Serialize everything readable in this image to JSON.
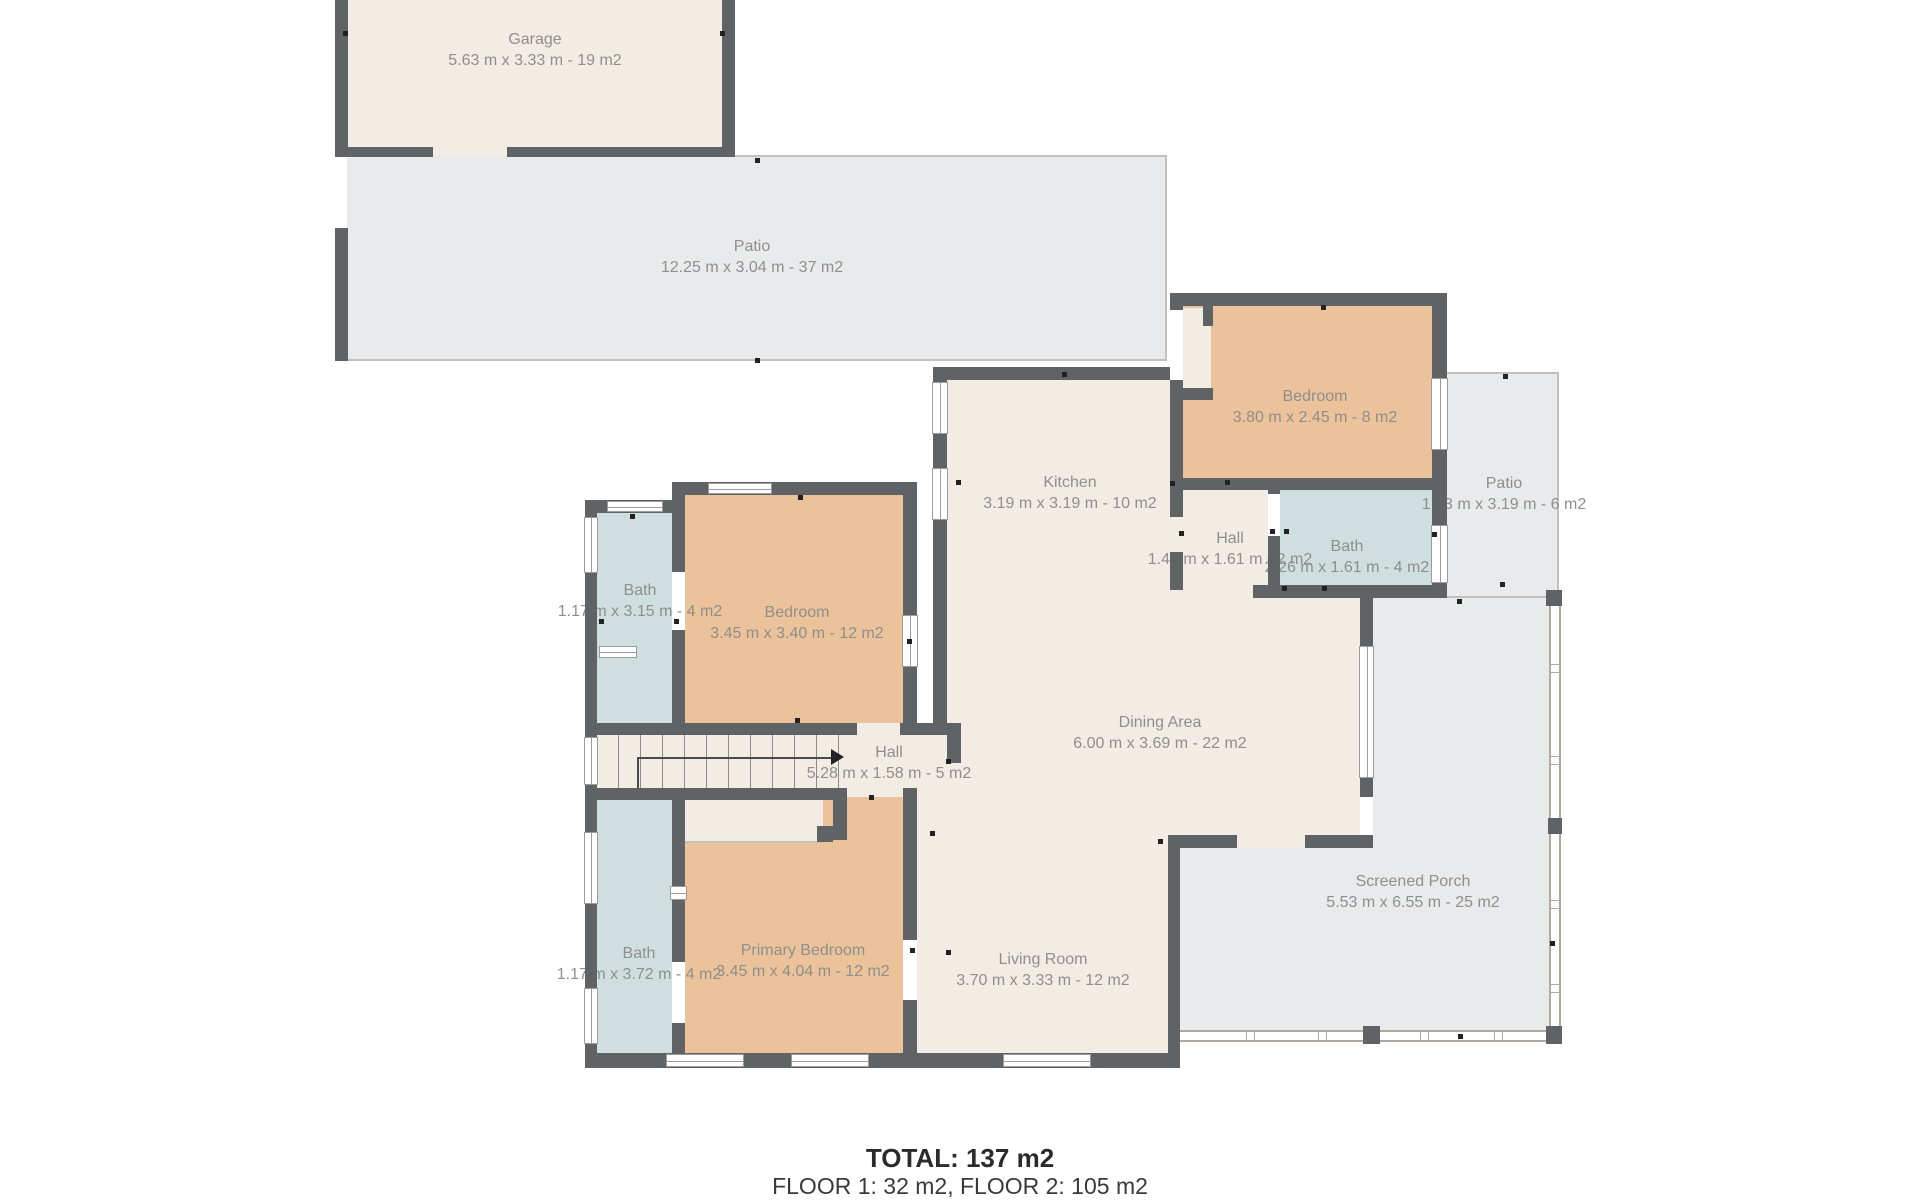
{
  "footer": {
    "total": "TOTAL: 137 m2",
    "floors": "FLOOR 1: 32 m2, FLOOR 2: 105 m2"
  },
  "rooms": {
    "garage": {
      "name": "Garage",
      "dims": "5.63 m x 3.33 m - 19 m2"
    },
    "patio_top": {
      "name": "Patio",
      "dims": "12.25 m x 3.04 m - 37 m2"
    },
    "bedroom_top_right": {
      "name": "Bedroom",
      "dims": "3.80 m x 2.45 m - 8 m2"
    },
    "patio_right": {
      "name": "Patio",
      "dims": "1.83 m x 3.19 m - 6 m2"
    },
    "kitchen": {
      "name": "Kitchen",
      "dims": "3.19 m x 3.19 m - 10 m2"
    },
    "hall_upper": {
      "name": "Hall",
      "dims": "1.44 m x 1.61 m - 2 m2"
    },
    "bath_upper_middle": {
      "name": "Bath",
      "dims": "2.26 m x 1.61 m - 4 m2"
    },
    "bath_upper_left": {
      "name": "Bath",
      "dims": "1.17 m x 3.15 m - 4 m2"
    },
    "bedroom_middle_left": {
      "name": "Bedroom",
      "dims": "3.45 m x 3.40 m - 12 m2"
    },
    "hall_stairs": {
      "name": "Hall",
      "dims": "5.28 m x 1.58 m - 5 m2"
    },
    "dining_area": {
      "name": "Dining Area",
      "dims": "6.00 m x 3.69 m - 22 m2"
    },
    "bath_lower_left": {
      "name": "Bath",
      "dims": "1.17 m x 3.72 m - 4 m2"
    },
    "primary_bedroom": {
      "name": "Primary Bedroom",
      "dims": "3.45 m x 4.04 m - 12 m2"
    },
    "living_room": {
      "name": "Living Room",
      "dims": "3.70 m x 3.33 m - 12 m2"
    },
    "screened_porch": {
      "name": "Screened Porch",
      "dims": "5.53 m x 6.55 m - 25 m2"
    }
  },
  "colors": {
    "wall": "#606366",
    "interior": "#f2ece4",
    "bedroom": "#ebc29a",
    "bath": "#cfdfe0",
    "outdoor": "#e9eaeb",
    "label_text": "#8f8f8d"
  }
}
